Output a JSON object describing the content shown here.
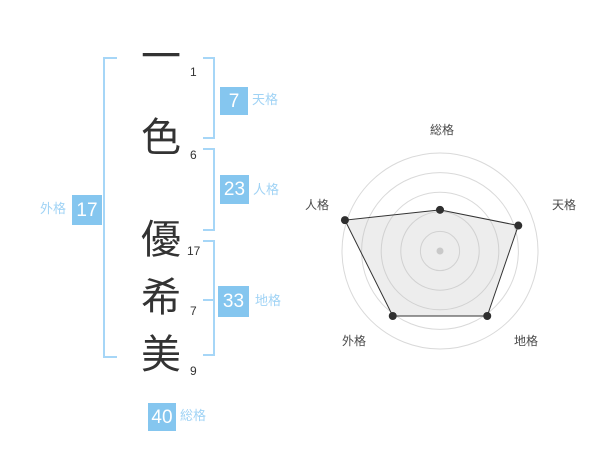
{
  "name": {
    "characters": [
      {
        "glyph": "一",
        "strokes": "1"
      },
      {
        "glyph": "色",
        "strokes": "6"
      },
      {
        "glyph": "優",
        "strokes": "17"
      },
      {
        "glyph": "希",
        "strokes": "7"
      },
      {
        "glyph": "美",
        "strokes": "9"
      }
    ],
    "badges": {
      "tenkaku": {
        "value": "7",
        "label": "天格"
      },
      "jinkaku": {
        "value": "23",
        "label": "人格"
      },
      "chikaku": {
        "value": "33",
        "label": "地格"
      },
      "gaikaku": {
        "value": "17",
        "label": "外格"
      },
      "soukaku": {
        "value": "40",
        "label": "総格"
      }
    }
  },
  "colors": {
    "badge_bg": "#85c6ef",
    "badge_text": "#ffffff",
    "kaku_label_text": "#a0d3f5",
    "bracket": "#a6d6f7",
    "name_text": "#333333"
  },
  "chart_data": {
    "type": "radar",
    "title": "",
    "axes": [
      "総格",
      "天格",
      "地格",
      "外格",
      "人格"
    ],
    "values": [
      2.1,
      4.2,
      4.1,
      4.1,
      5.1
    ],
    "scale_max": 5,
    "rings": 5,
    "angles_deg": [
      90,
      18,
      -54,
      -126,
      -198
    ],
    "legend": "none",
    "grid": "concentric-circles",
    "colors": {
      "ring": "#d9d9d9",
      "polygon_fill": "rgba(190,190,190,0.28)",
      "polygon_stroke": "#333333",
      "point": "#2f2f2f",
      "center_dot": "#c9c9c9",
      "label": "#4a4a4a"
    }
  }
}
